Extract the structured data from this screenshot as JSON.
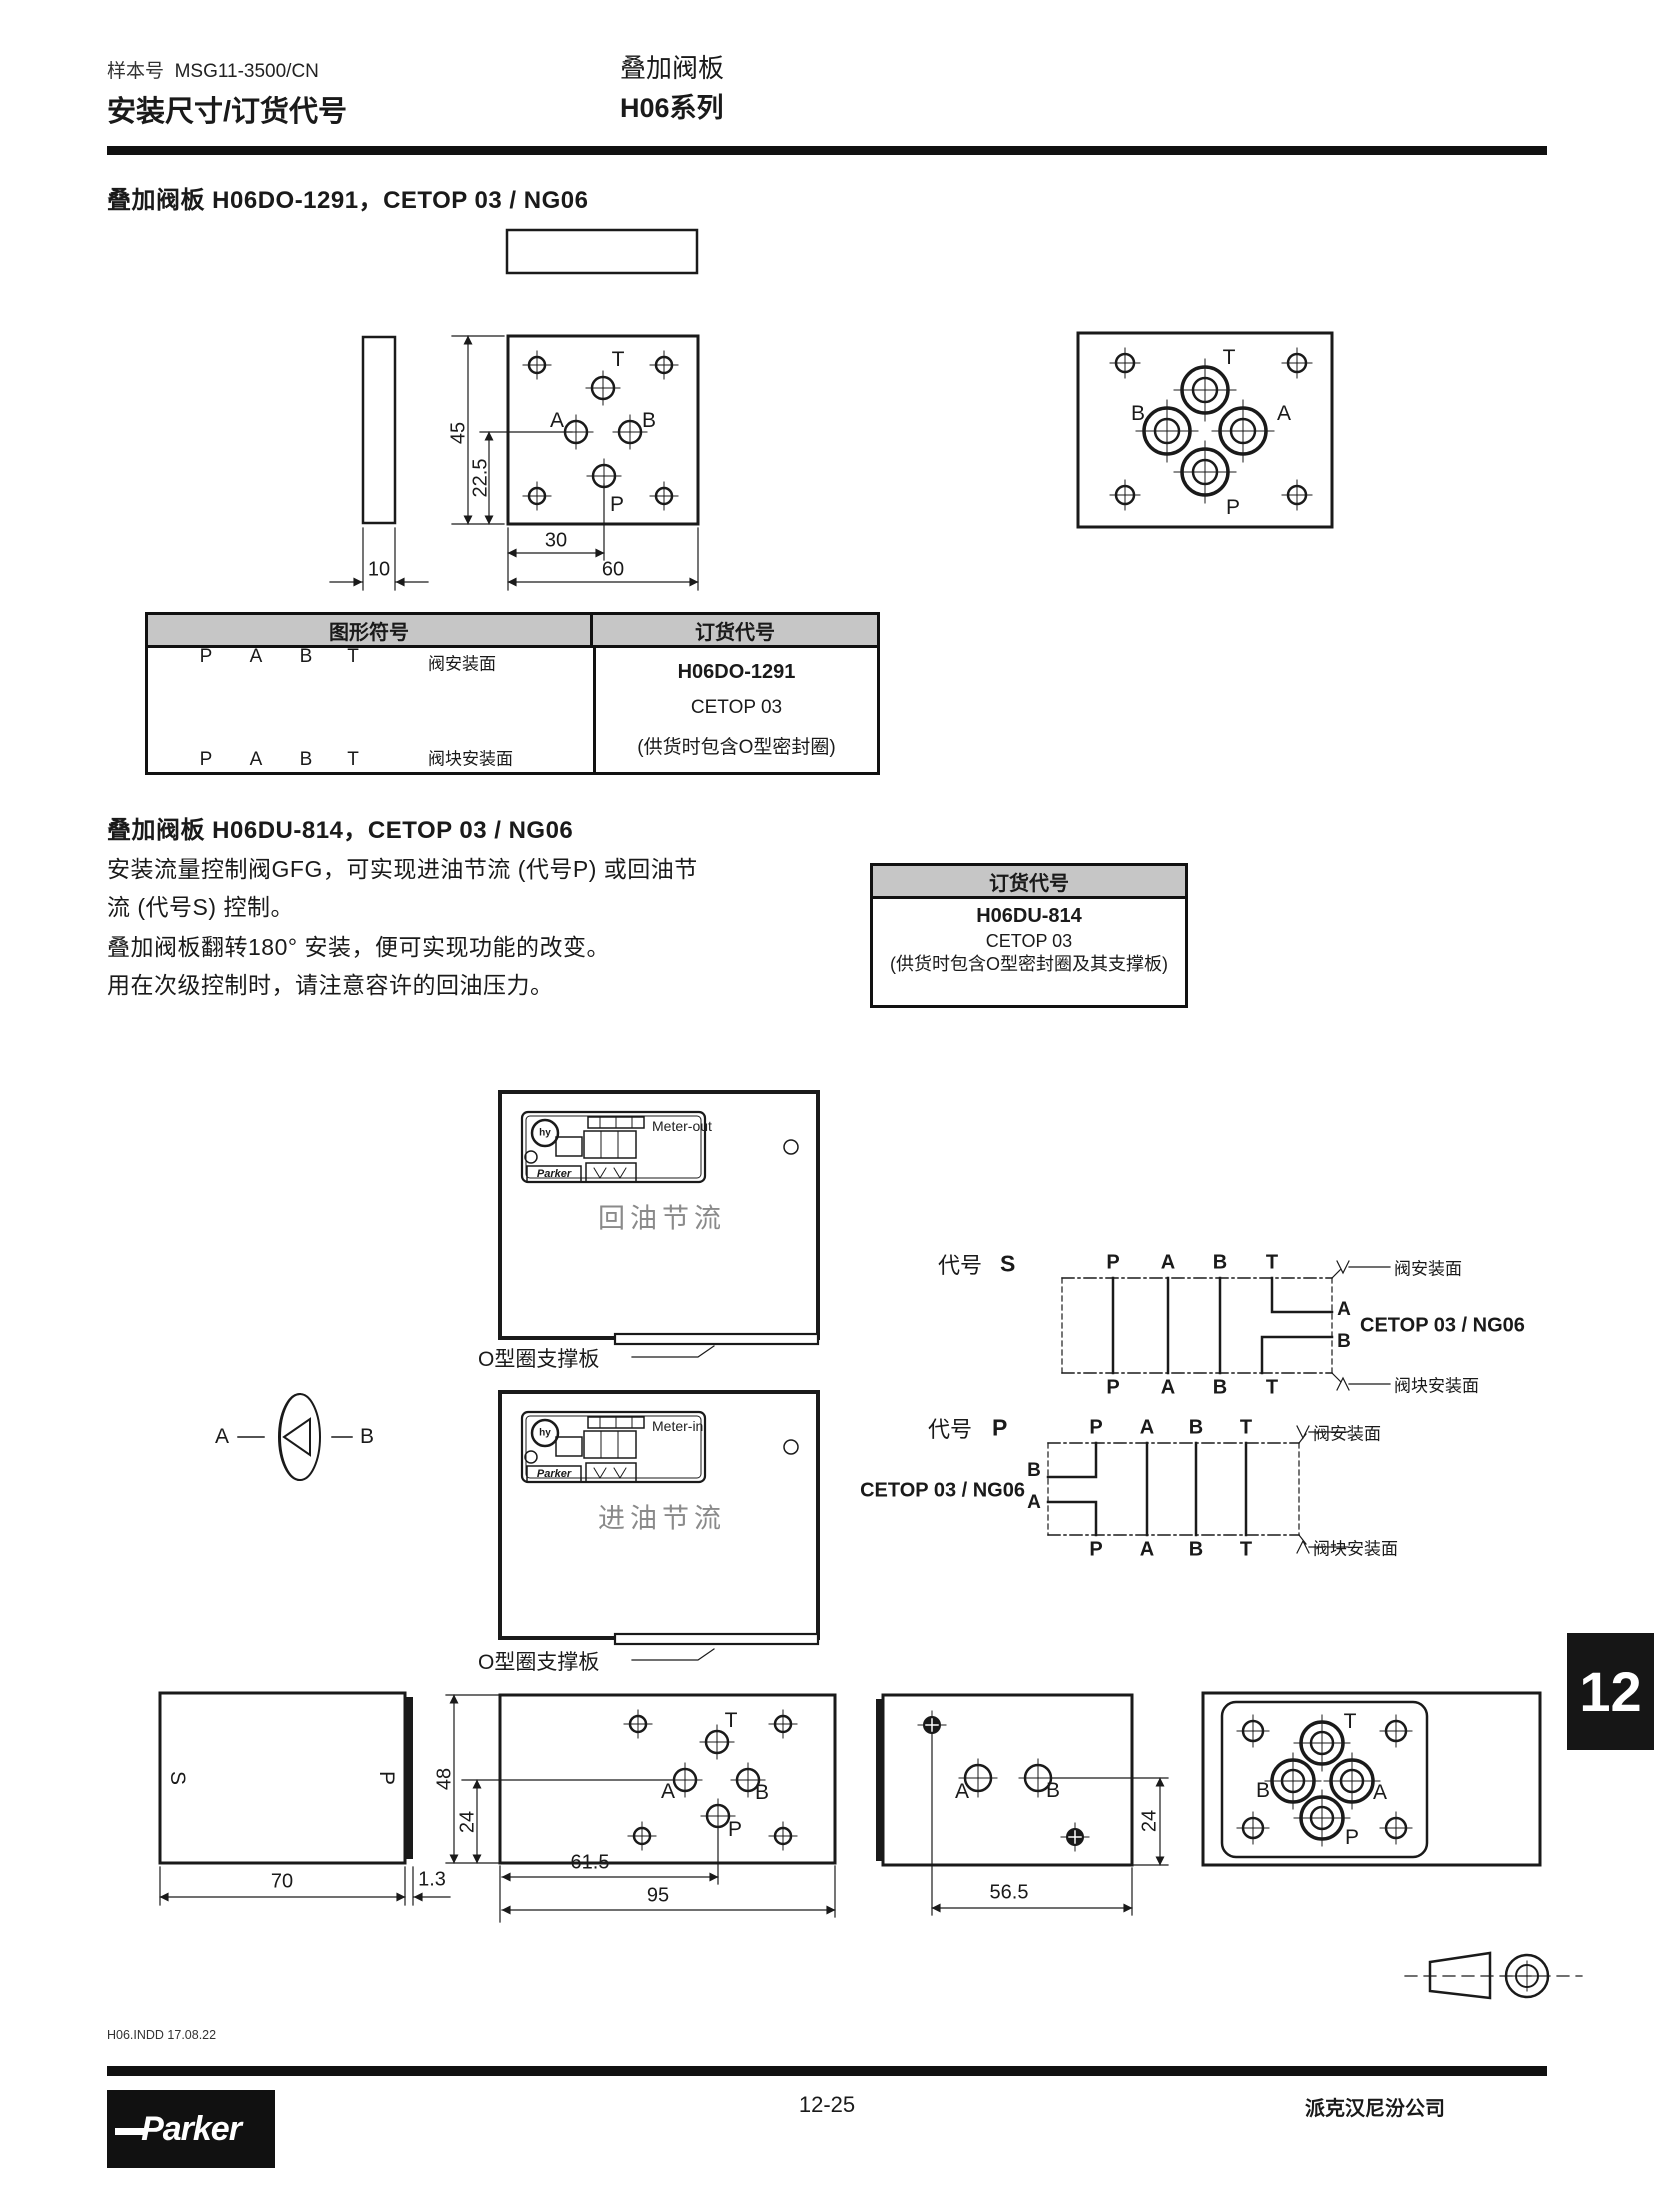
{
  "header": {
    "doc_label": "样本号",
    "doc_number": "MSG11-3500/CN",
    "title_left": "安装尺寸/订货代号",
    "title_right_line1": "叠加阀板",
    "title_right_line2": "H06系列"
  },
  "section1": {
    "title": "叠加阀板 H06DO-1291，CETOP 03 / NG06",
    "drawing": {
      "dim_45": "45",
      "dim_225": "22.5",
      "dim_30": "30",
      "dim_60": "60",
      "dim_10": "10",
      "plan": {
        "t": "T",
        "a": "A",
        "b": "B",
        "p": "P"
      },
      "face": {
        "t": "T",
        "b": "B",
        "a": "A",
        "p": "P"
      }
    }
  },
  "table1": {
    "col_symbol": "图形符号",
    "col_code": "订货代号",
    "ports": [
      "P",
      "A",
      "B",
      "T"
    ],
    "face_top": "阀安装面",
    "face_bottom": "阀块安装面",
    "code": "H06DO-1291",
    "cetop": "CETOP 03",
    "note": "(供货时包含O型密封圈)"
  },
  "section2": {
    "title": "叠加阀板 H06DU-814，CETOP 03 / NG06",
    "p1": "安装流量控制阀GFG，可实现进油节流 (代号P) 或回油节流 (代号S) 控制。",
    "p2": "叠加阀板翻转180° 安装，便可实现功能的改变。",
    "p3": "用在次级控制时，请注意容许的回油压力。"
  },
  "order2": {
    "header": "订货代号",
    "code": "H06DU-814",
    "cetop": "CETOP 03",
    "note": "(供货时包含O型密封圈及其支撑板)"
  },
  "meter_out": {
    "tag": "Meter-out",
    "label": "回油节流",
    "support": "O型圈支撑板",
    "logo": "hy",
    "brand": "Parker"
  },
  "meter_in": {
    "tag": "Meter-in",
    "label": "进油节流",
    "support": "O型圈支撑板",
    "logo": "hy",
    "brand": "Parker"
  },
  "rotation": {
    "a": "A",
    "b": "B"
  },
  "code_s": {
    "prefix": "代号",
    "code": "S",
    "top": [
      "P",
      "A",
      "B",
      "T"
    ],
    "bottom": [
      "P",
      "A",
      "B",
      "T"
    ],
    "out_a": "A",
    "out_b": "B",
    "cetop": "CETOP 03 / NG06",
    "face_top": "阀安装面",
    "face_bottom": "阀块安装面"
  },
  "code_p": {
    "prefix": "代号",
    "code": "P",
    "top": [
      "P",
      "A",
      "B",
      "T"
    ],
    "bottom": [
      "P",
      "A",
      "B",
      "T"
    ],
    "out_b": "B",
    "out_a": "A",
    "cetop": "CETOP 03 / NG06",
    "face_top": "阀安装面",
    "face_bottom": "阀块安装面"
  },
  "bottom": {
    "d1": {
      "s": "S",
      "p": "P",
      "dim_w": "70",
      "dim_t": "1.3"
    },
    "d2": {
      "dim_h": "48",
      "dim_mid": "24",
      "t": "T",
      "a": "A",
      "b": "B",
      "p": "P",
      "dim_a": "61.5",
      "dim_w": "95"
    },
    "d3": {
      "a": "A",
      "b": "B",
      "dim_mid": "24",
      "dim_w": "56.5"
    },
    "d4": {
      "t": "T",
      "b": "B",
      "a": "A",
      "p": "P"
    }
  },
  "page_tab": "12",
  "footer": {
    "file": "H06.INDD  17.08.22",
    "page": "12-25",
    "company": "派克汉尼汾公司",
    "brand": "Parker"
  }
}
